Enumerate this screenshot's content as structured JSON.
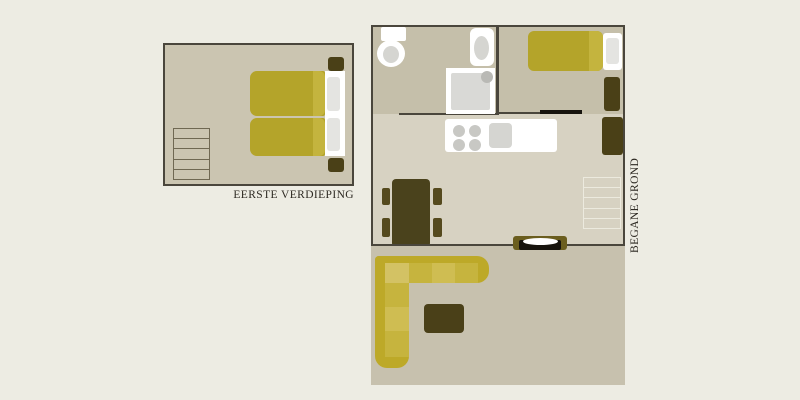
{
  "labels": {
    "first_floor": "EERSTE VERDIEPING",
    "ground_floor": "BEGANE GROND"
  },
  "colors": {
    "page_bg": "#edece3",
    "wall": "#4a463c",
    "floor_first": "#cbc5b1",
    "floor_rooms": "#c5bfaa",
    "floor_hall": "#d7d2c2",
    "floor_living": "#c7c1ae",
    "gold": "#b4a42a",
    "gold_light": "#c4b43e",
    "sofa_back": "#bda928",
    "cushion": "#cfbd52",
    "cushion_alt": "#c6b43e",
    "cushion_corner": "#d3c264",
    "dark_furniture": "#4a4017",
    "chair": "#554a1e",
    "door_frame": "#6b5e1e",
    "door_dark": "#17140e",
    "white": "#ffffff",
    "pillow": "#e4e4e1",
    "fixture_gray": "#d5d5d1",
    "burner_gray": "#c8c8c4",
    "shower_head": "#b9b9b5",
    "stair_line_dark": "#6f6852",
    "stair_line_light": "#eceade",
    "label_text": "#2d2922"
  }
}
